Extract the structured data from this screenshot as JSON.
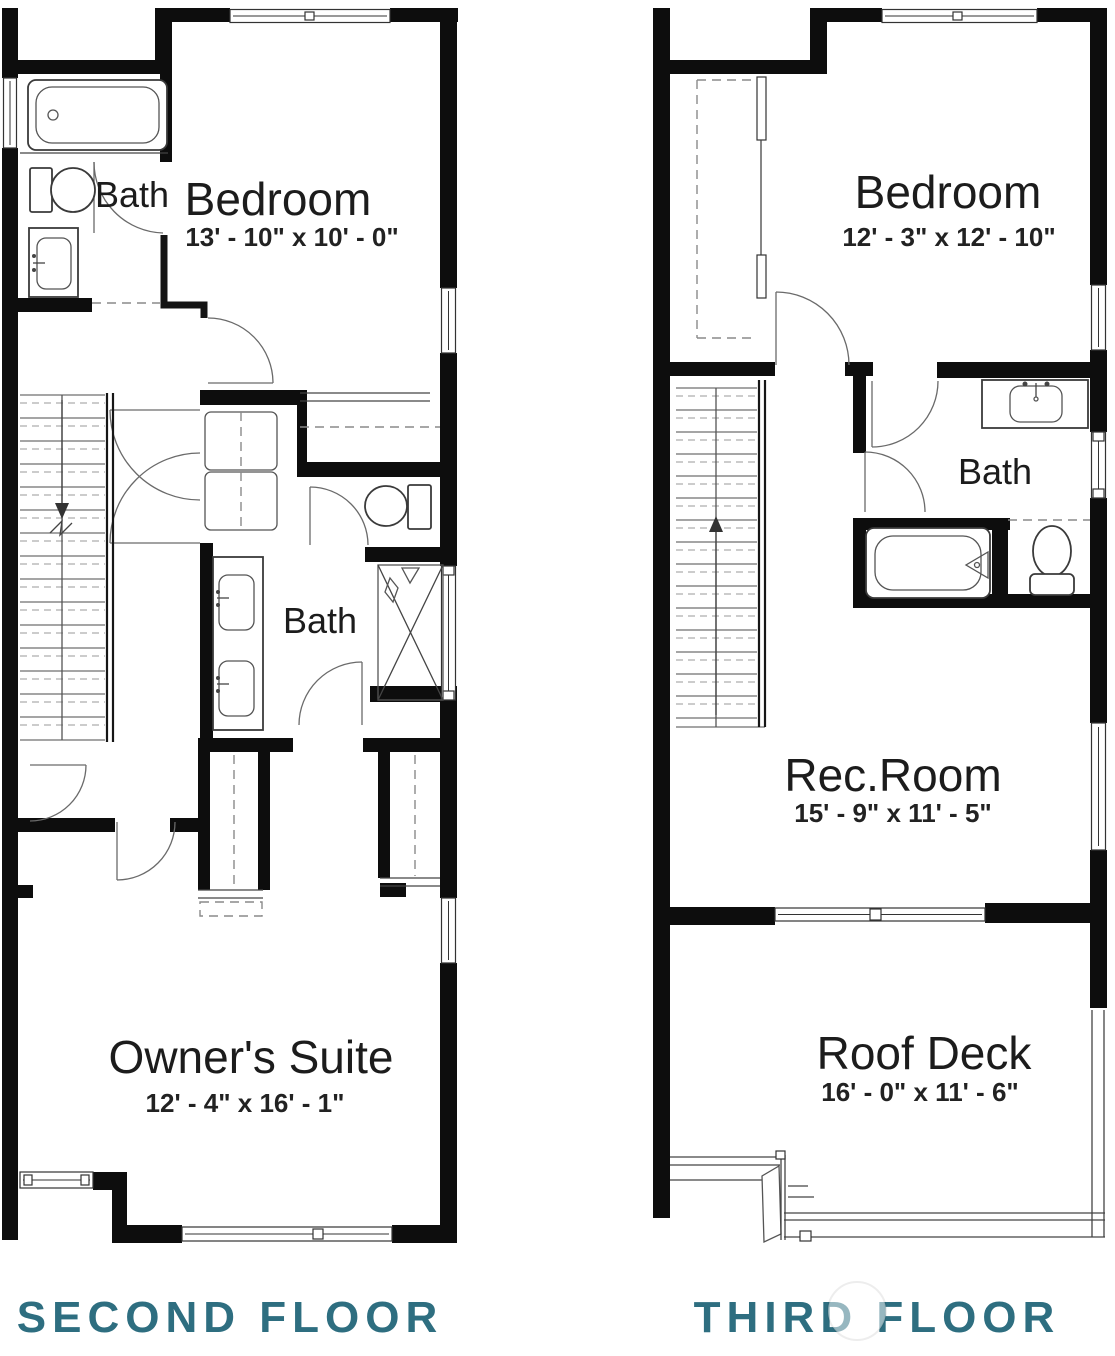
{
  "document": {
    "type": "residential floor plan"
  },
  "floors": [
    {
      "title": "SECOND FLOOR",
      "rooms": [
        {
          "name": "Bath"
        },
        {
          "name": "Bedroom",
          "dims": "13' - 10\" x 10' - 0\""
        },
        {
          "name": "Bath"
        },
        {
          "name": "Owner's Suite",
          "dims": "12' - 4\" x 16' - 1\""
        }
      ]
    },
    {
      "title": "THIRD FLOOR",
      "rooms": [
        {
          "name": "Bedroom",
          "dims": "12' - 3\" x 12' - 10\""
        },
        {
          "name": "Bath"
        },
        {
          "name": "Rec.Room",
          "dims": "15' - 9\" x 11' - 5\""
        },
        {
          "name": "Roof Deck",
          "dims": "16' - 0\" x 11' - 6\""
        }
      ]
    }
  ],
  "colors": {
    "floor_label": "#2e6e80",
    "wall": "#0d0d0d",
    "background": "#ffffff"
  }
}
